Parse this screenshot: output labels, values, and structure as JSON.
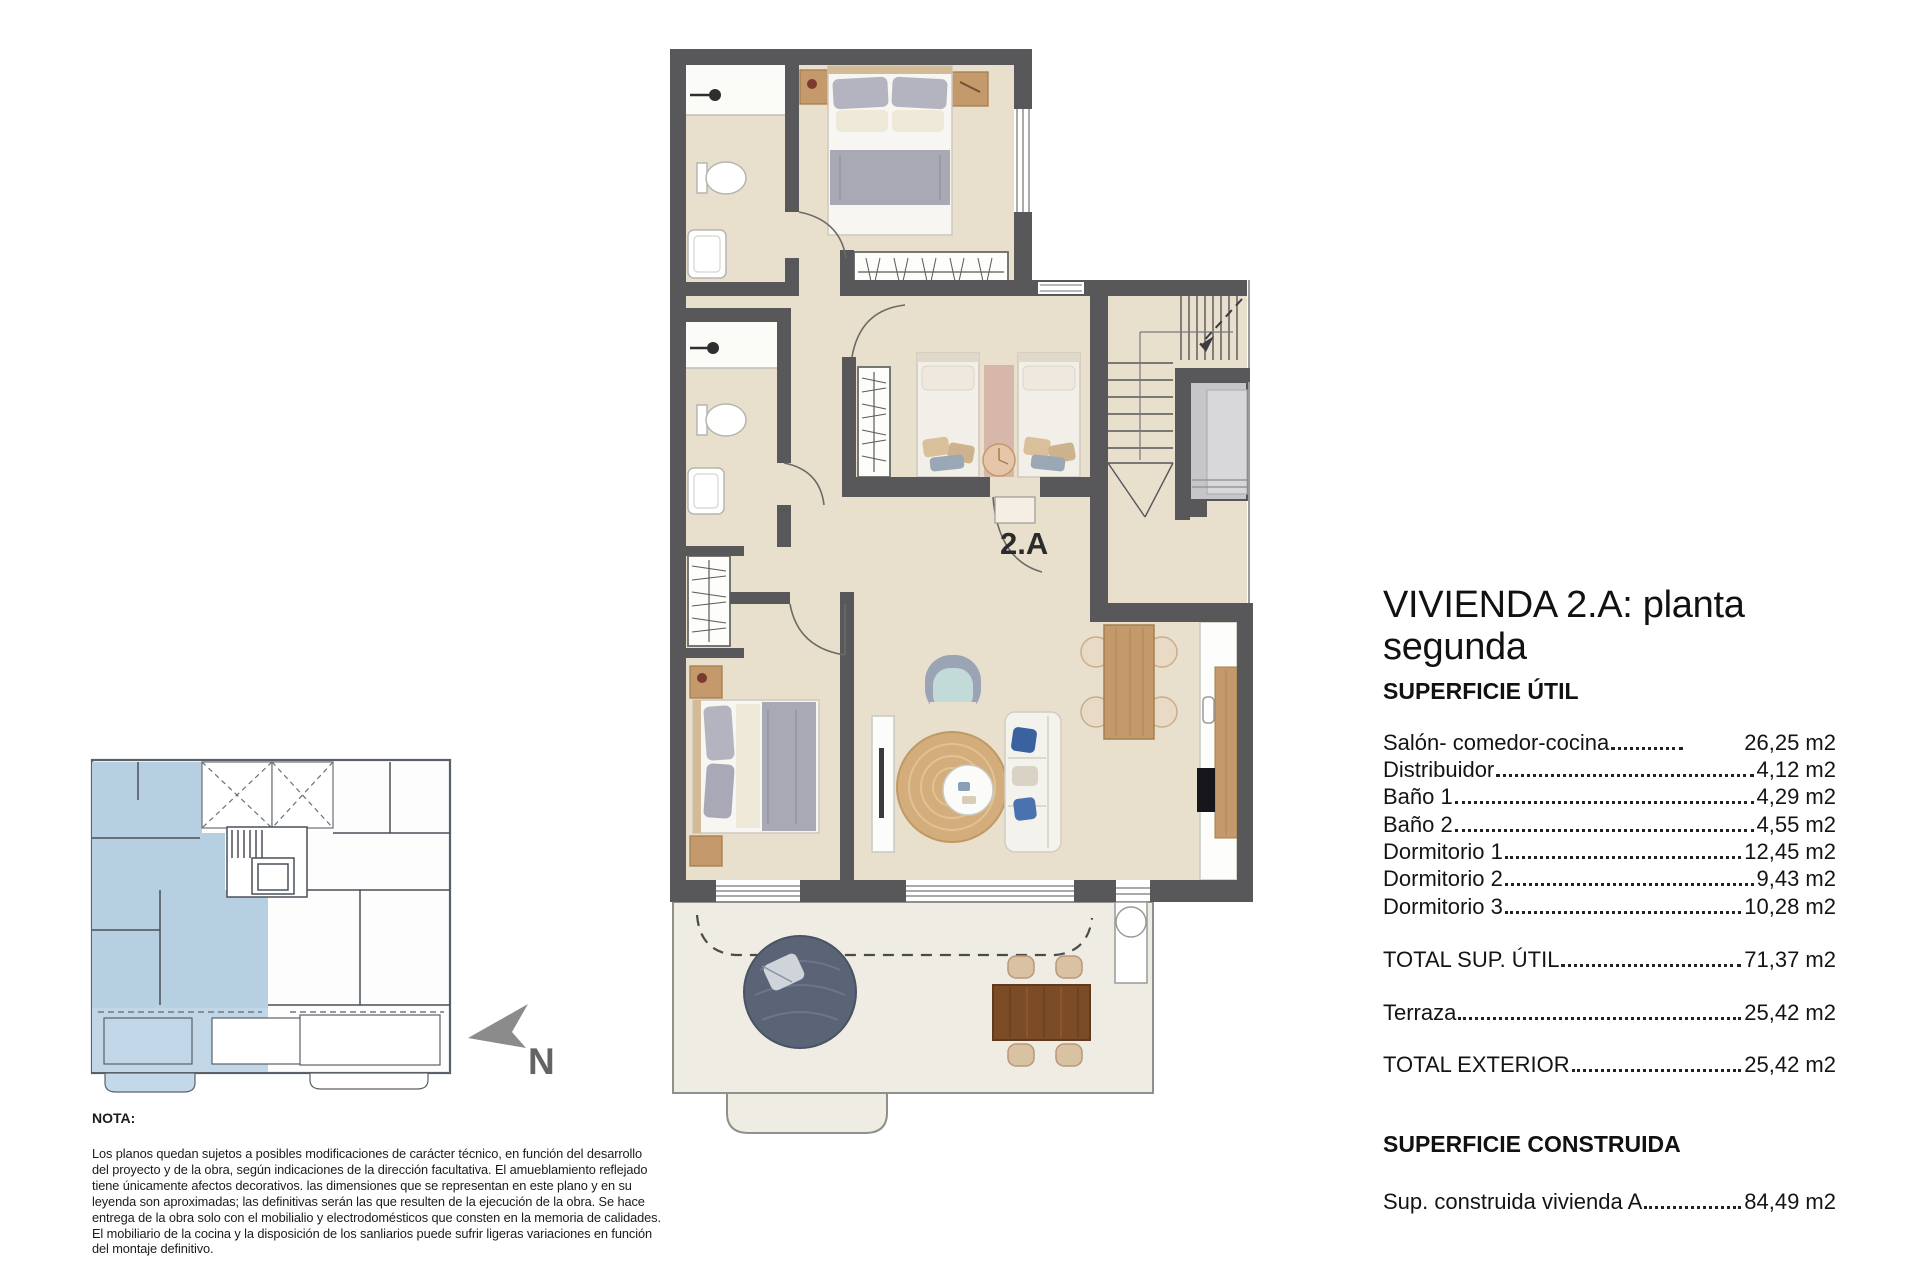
{
  "plan": {
    "unit_label": "2.A"
  },
  "north_arrow": {
    "label": "N"
  },
  "info_panel": {
    "title": "VIVIENDA 2.A: planta segunda",
    "section_util": "SUPERFICIE ÚTIL",
    "rooms": [
      {
        "label": "Salón- comedor-cocina",
        "value": "26,25 m2",
        "short_leader": true
      },
      {
        "label": "Distribuidor",
        "value": "4,12 m2"
      },
      {
        "label": "Baño 1",
        "value": "4,29 m2"
      },
      {
        "label": "Baño 2",
        "value": "4,55 m2"
      },
      {
        "label": "Dormitorio 1",
        "value": "12,45 m2"
      },
      {
        "label": "Dormitorio 2",
        "value": "9,43 m2"
      },
      {
        "label": "Dormitorio 3",
        "value": "10,28 m2"
      }
    ],
    "totals": [
      {
        "label": "TOTAL SUP. ÚTIL",
        "value": "71,37 m2"
      },
      {
        "label": "Terraza",
        "value": "25,42 m2"
      },
      {
        "label": "TOTAL EXTERIOR",
        "value": "25,42 m2"
      }
    ],
    "section_construida": "SUPERFICIE CONSTRUIDA",
    "construida": {
      "label": "Sup. construida vivienda A",
      "value": "84,49 m2"
    }
  },
  "note": {
    "heading": "NOTA:",
    "body": "Los planos quedan sujetos a posibles modificaciones de carácter técnico, en función del desarrollo\ndel proyecto y de la obra, según indicaciones de la dirección facultativa. El amueblamiento reflejado\ntiene únicamente afectos decorativos. las dimensiones que se representan en este plano y en su\nleyenda son aproximadas; las definitivas serán las que resulten de la ejecución de la obra. Se hace\nentrega de la obra solo con el mobilialio y electrodomésticos que consten en la memoria de calidades.\nEl mobiliario de la cocina y la disposición de los sanliarios puede sufrir ligeras variaciones en función\ndel montaje definitivo."
  },
  "colors": {
    "wall": "#58585a",
    "floor": "#e8e0cd",
    "terrace_floor": "#efece4",
    "keyplan_highlight": "#b6cfe1",
    "wood": "#c49a6c",
    "terrace_wood": "#7c4c27",
    "bed_grey": "#a9a9b6",
    "armchair_seat": "#c2dbd8",
    "beanbag": "#5b6477",
    "north_arrow_grey": "#8b8b8b"
  }
}
